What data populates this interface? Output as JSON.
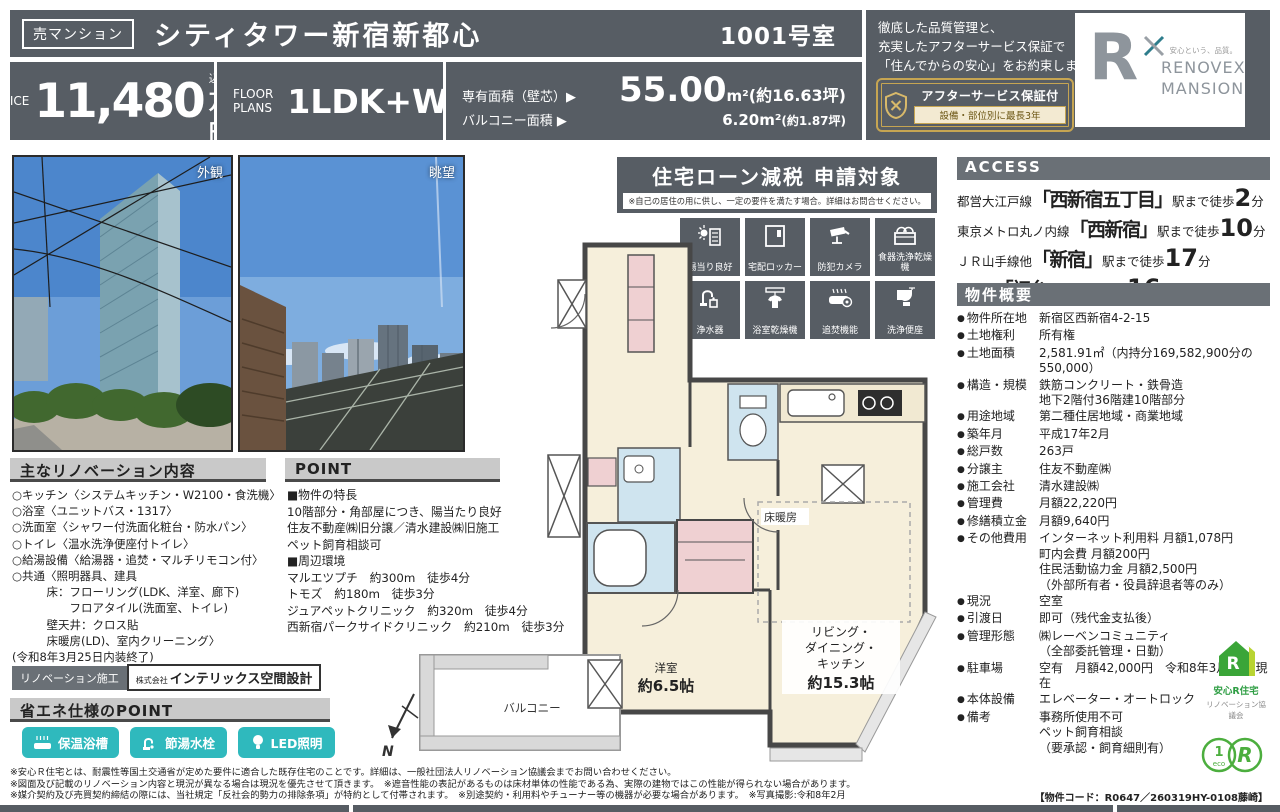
{
  "header": {
    "badge": "売マンション",
    "title": "シティタワー新宿新都心",
    "room": "1001号室",
    "price_label": "PRICE",
    "price_value": "11,480",
    "price_tax": "（税込）",
    "price_unit": "万円",
    "floor_label_1": "FLOOR",
    "floor_label_2": "PLANS",
    "floor_value": "1LDK+W",
    "area1_label": "専有面積（壁芯）▶",
    "area1_value": "55.00",
    "area1_unit": "m²",
    "area1_tsubo": "(約16.63坪)",
    "area2_label": "バルコニー面積 ▶",
    "area2_value": "6.20m²",
    "area2_tsubo": "(約1.87坪)",
    "quality_lines": [
      "徹底した品質管理と、",
      "充実したアフターサービス保証で",
      "「住んでからの安心」をお約束します。"
    ],
    "warranty_title": "アフターサービス保証付",
    "warranty_sub": "設備・部位別に最長3年",
    "logo": {
      "r": "R",
      "tagline": "安心という、品質。",
      "line1": "RENOVEX",
      "line2": "MANSION"
    }
  },
  "photos": {
    "left_label": "外観",
    "right_label": "眺望"
  },
  "loan": {
    "title": "住宅ローン減税 申請対象",
    "note": "※自己の居住の用に供し、一定の要件を満たす場合。詳細はお問合せください。"
  },
  "features": [
    "陽当り良好",
    "宅配ロッカー",
    "防犯カメラ",
    "食器洗浄乾燥機",
    "浄水器",
    "浴室乾燥機",
    "追焚機能",
    "洗浄便座"
  ],
  "floorplan": {
    "heating": "床暖房",
    "ldk": [
      "リビング・",
      "ダイニング・",
      "キッチン"
    ],
    "ldk_size": "約15.3帖",
    "bedroom": "洋室",
    "bedroom_size": "約6.5帖",
    "balcony": "バルコニー",
    "north": "N"
  },
  "renovation": {
    "header": "主なリノベーション内容",
    "items": [
      "○キッチン〈システムキッチン・W2100・食洗機〉",
      "○浴室〈ユニットバス・1317〉",
      "○洗面室〈シャワー付洗面化粧台・防水パン〉",
      "○トイレ〈温水洗浄便座付トイレ〉",
      "○給湯設備〈給湯器・追焚・マルチリモコン付〉",
      "○共通〈照明器具、建具",
      "　　　床：フローリング(LDK、洋室、廊下)",
      "　　　　　フロアタイル(洗面室、トイレ)",
      "　　　壁天井：クロス貼",
      "　　　床暖房(LD)、室内クリーニング〉",
      "(令和8年3月25日内装終了)"
    ],
    "badge": "リノベーション施工",
    "company_prefix": "株式会社",
    "company": "インテリックス空間設計"
  },
  "point": {
    "header": "POINT",
    "lines": [
      "■物件の特長",
      "10階部分・角部屋につき、陽当たり良好",
      "住友不動産㈱旧分譲／清水建設㈱旧施工",
      "ペット飼育相談可",
      "■周辺環境",
      "マルエツプチ　約300m　徒歩4分",
      "トモズ　約180m　徒歩3分",
      "ジュアペットクリニック　約320m　徒歩4分",
      "西新宿パークサイドクリニック　約210m　徒歩3分"
    ]
  },
  "access": {
    "header": "ACCESS",
    "lines": [
      {
        "pre": "都営大江戸線",
        "station": "「西新宿五丁目」",
        "mid": "駅まで徒歩",
        "num": "2",
        "unit": "分"
      },
      {
        "pre": "東京メトロ丸ノ内線",
        "station": "「西新宿」",
        "mid": "駅まで徒歩",
        "num": "10",
        "unit": "分"
      },
      {
        "pre": "ＪＲ山手線他",
        "station": "「新宿」",
        "mid": "駅まで徒歩",
        "num": "17",
        "unit": "分"
      },
      {
        "pre": "京王線",
        "station": "「初台」",
        "mid": "駅まで徒歩",
        "num": "16",
        "unit": "分"
      }
    ]
  },
  "overview": {
    "header": "物件概要",
    "rows": [
      {
        "label": "物件所在地",
        "value": [
          "新宿区西新宿4-2-15"
        ]
      },
      {
        "label": "土地権利",
        "value": [
          "所有権"
        ]
      },
      {
        "label": "土地面積",
        "value": [
          "2,581.91㎡（内持分169,582,900分の550,000）"
        ]
      },
      {
        "label": "構造・規模",
        "value": [
          "鉄筋コンクリート・鉄骨造",
          "地下2階付36階建10階部分"
        ]
      },
      {
        "label": "用途地域",
        "value": [
          "第二種住居地域・商業地域"
        ]
      },
      {
        "label": "築年月",
        "value": [
          "平成17年2月"
        ]
      },
      {
        "label": "総戸数",
        "value": [
          "263戸"
        ]
      },
      {
        "label": "分譲主",
        "value": [
          "住友不動産㈱"
        ]
      },
      {
        "label": "施工会社",
        "value": [
          "清水建設㈱"
        ]
      },
      {
        "label": "管理費",
        "value": [
          "月額22,220円"
        ]
      },
      {
        "label": "修繕積立金",
        "value": [
          "月額9,640円"
        ]
      },
      {
        "label": "その他費用",
        "value": [
          "インターネット利用料 月額1,078円",
          "町内会費 月額200円",
          "住民活動協力金 月額2,500円",
          "（外部所有者・役員辞退者等のみ）"
        ]
      },
      {
        "label": "現況",
        "value": [
          "空室"
        ]
      },
      {
        "label": "引渡日",
        "value": [
          "即可（残代金支払後）"
        ]
      },
      {
        "label": "管理形態",
        "value": [
          "㈱レーベンコミュニティ",
          "（全部委託管理・日勤）"
        ]
      },
      {
        "label": "駐車場",
        "value": [
          "空有　月額42,000円　令和8年3月19日現在"
        ]
      },
      {
        "label": "本体設備",
        "value": [
          "エレベーター・オートロック"
        ]
      },
      {
        "label": "備考",
        "value": [
          "事務所使用不可",
          "ペット飼育相談",
          "（要承認・飼育細則有）"
        ]
      }
    ]
  },
  "eco": {
    "header": "省エネ仕様のPOINT",
    "buttons": [
      "保温浴槽",
      "節湯水栓",
      "LED照明"
    ]
  },
  "anshin": {
    "name": "安心R住宅",
    "org": "リノベーション協議会",
    "circle1_top": "1",
    "circle1_bottom": "eco",
    "circle2": "R"
  },
  "footer": {
    "disclaimers": [
      "※安心Ｒ住宅とは、耐震性等国土交通省が定めた要件に適合した既存住宅のことです。詳細は、一般社団法人リノベーション協議会までお問い合わせください。",
      "※図面及び記載のリノベーション内容と現況が異なる場合は現況を優先させて頂きます。　※遮音性能の表記があるものは床材単体の性能である為、実際の建物ではこの性能が得られない場合があります。",
      "※媒介契約及び売買契約締結の際には、当社規定「反社会的勢力の排除条項」が特約として付帯されます。　※別途契約・利用料やチューナー等の機器が必要な場合があります。　※写真撮影:令和8年2月"
    ],
    "code": "【物件コード：R0647／260319HY-0108藤崎】"
  },
  "colors": {
    "slate": "#575d64",
    "bar_dark": "#6a7076",
    "teal": "#2fb9bd",
    "gold": "#c6a552",
    "green": "#3aa538"
  }
}
